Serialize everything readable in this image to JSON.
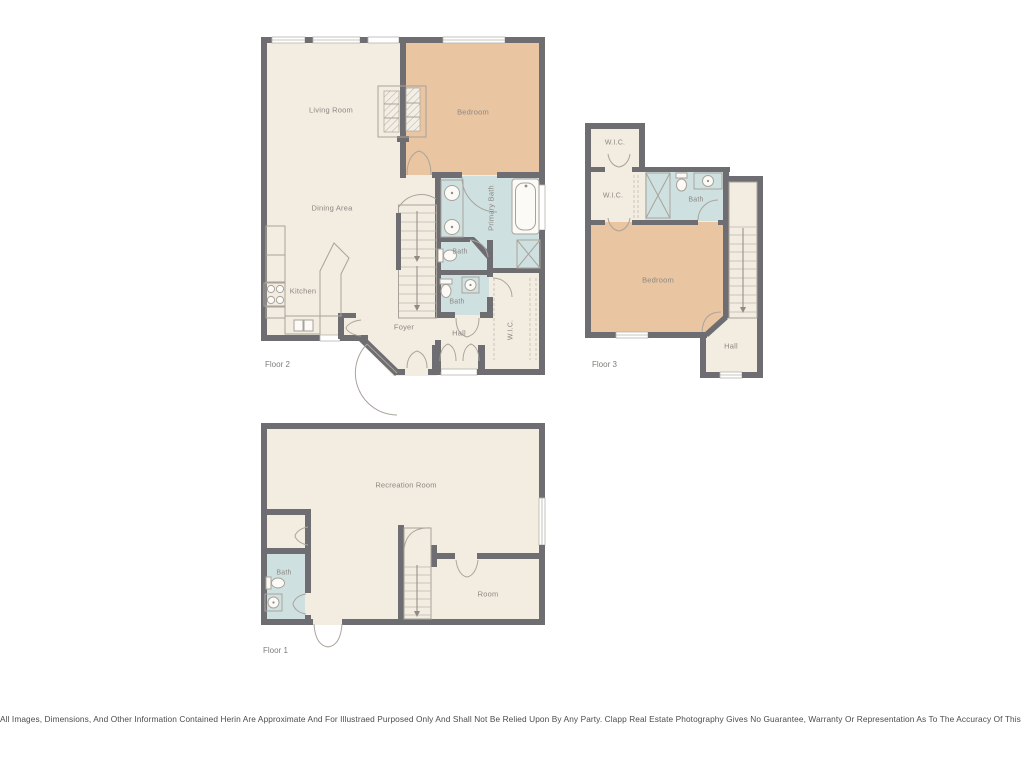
{
  "colors": {
    "background": "#ffffff",
    "wall": "#6e6d71",
    "floor_cream": "#f2ece1",
    "floor_bedroom_tan": "#e9c5a1",
    "floor_bath_blue": "#cfe0e1",
    "fixture_stroke": "#a8a39a",
    "room_label_text": "#8b8883",
    "floor_tag_text": "#7f7d78",
    "disclaimer_text": "#4c4c4c"
  },
  "floor2": {
    "label": "Floor 2",
    "rooms": {
      "living_room": "Living Room",
      "bedroom": "Bedroom",
      "dining_area": "Dining Area",
      "kitchen": "Kitchen",
      "primary_bath": "Primary Bath",
      "bath_upper": "Bath",
      "bath_lower": "Bath",
      "foyer": "Foyer",
      "hall": "Hall",
      "wic": "W.I.C."
    }
  },
  "floor3": {
    "label": "Floor 3",
    "rooms": {
      "wic_upper": "W.I.C.",
      "wic_lower": "W.I.C.",
      "bath": "Bath",
      "bedroom": "Bedroom",
      "hall": "Hall"
    }
  },
  "floor1": {
    "label": "Floor 1",
    "rooms": {
      "recreation_room": "Recreation Room",
      "bath": "Bath",
      "room": "Room"
    }
  },
  "disclaimer": "All Images, Dimensions, And Other Information Contained Herin Are Approximate And For Illustraed Purposed Only And Shall Not Be Relied Upon By Any Party. Clapp Real Estate Photography Gives No Guarantee, Warranty Or Representation As To The Accuracy Of This Information."
}
